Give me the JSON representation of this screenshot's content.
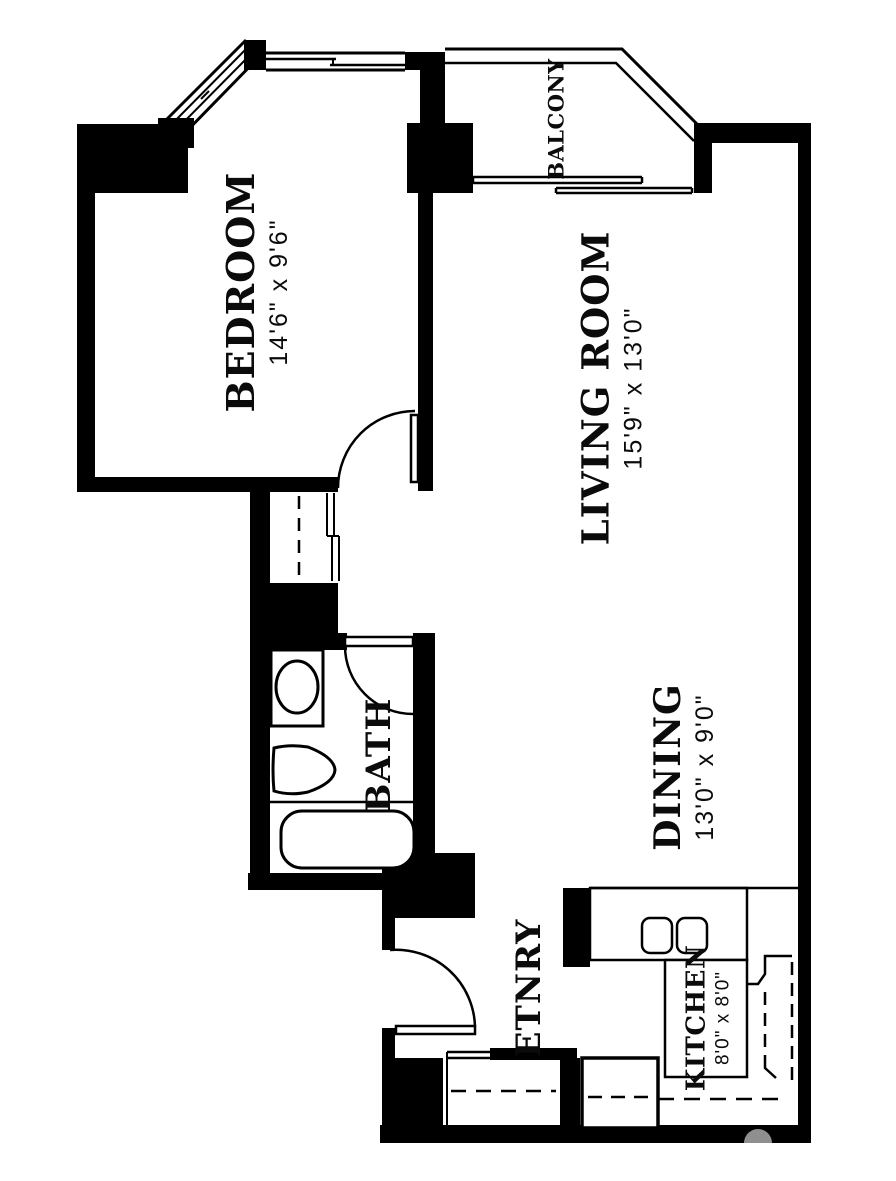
{
  "floorplan": {
    "rooms": [
      {
        "id": "bedroom",
        "name": "BEDROOM",
        "dims": "14'6\" x 9'6\""
      },
      {
        "id": "living",
        "name": "LIVING ROOM",
        "dims": "15'9\" x 13'0\""
      },
      {
        "id": "dining",
        "name": "DINING",
        "dims": "13'0\" x 9'0\""
      },
      {
        "id": "kitchen",
        "name": "KITCHEN",
        "dims": "8'0\" x 8'0\""
      },
      {
        "id": "bath",
        "name": "BATH",
        "dims": ""
      },
      {
        "id": "entry",
        "name": "ETNRY",
        "dims": ""
      },
      {
        "id": "balcony",
        "name": "BALCONY",
        "dims": ""
      }
    ],
    "colors": {
      "wall": "#000000",
      "background": "#ffffff",
      "watermark": "#8f8f8f"
    },
    "fixtures": [
      "bathtub",
      "toilet",
      "sink-vanity",
      "stove-burners",
      "kitchen-sink-cabinet",
      "refrigerator",
      "hall-closet-rod",
      "entry-closet-rod",
      "swing-doors",
      "bay-window",
      "balcony-sliding-door"
    ]
  }
}
